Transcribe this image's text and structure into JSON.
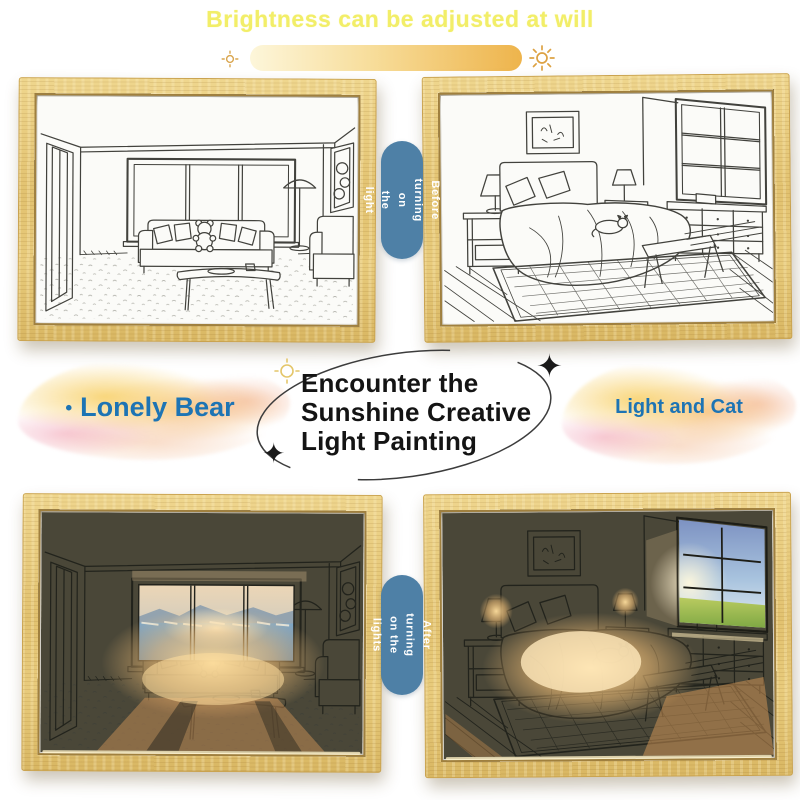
{
  "header": {
    "title": "Brightness can be adjusted at will"
  },
  "brightness": {
    "low_icon": "sun-dim",
    "high_icon": "sun-bright"
  },
  "captions": {
    "before": {
      "line1": "Before turning on",
      "line2": "the light"
    },
    "after": {
      "line1": "After turning",
      "line2": "on the lights"
    }
  },
  "center": {
    "heading": {
      "line1": "Encounter the",
      "line2": "Sunshine Creative",
      "line3": "Light Painting"
    },
    "sparkle_glyph": "✦"
  },
  "products": {
    "left": {
      "bullet": "•",
      "name": "Lonely Bear"
    },
    "right": {
      "name": "Light and Cat"
    }
  },
  "frames": {
    "top_left": {
      "scene": "living-room",
      "state": "sketch"
    },
    "top_right": {
      "scene": "bedroom",
      "state": "sketch"
    },
    "bottom_left": {
      "scene": "living-room",
      "state": "lit"
    },
    "bottom_right": {
      "scene": "bedroom",
      "state": "lit"
    }
  },
  "colors": {
    "title_yellow": "#f2ee68",
    "bar_gradient_start": "#fdf6da",
    "bar_gradient_end": "#eeb44c",
    "sun_gold": "#d9a54e",
    "pill_blue": "#4e80a6",
    "tag_blue": "#1d74b4",
    "wood": "#e3c678"
  }
}
